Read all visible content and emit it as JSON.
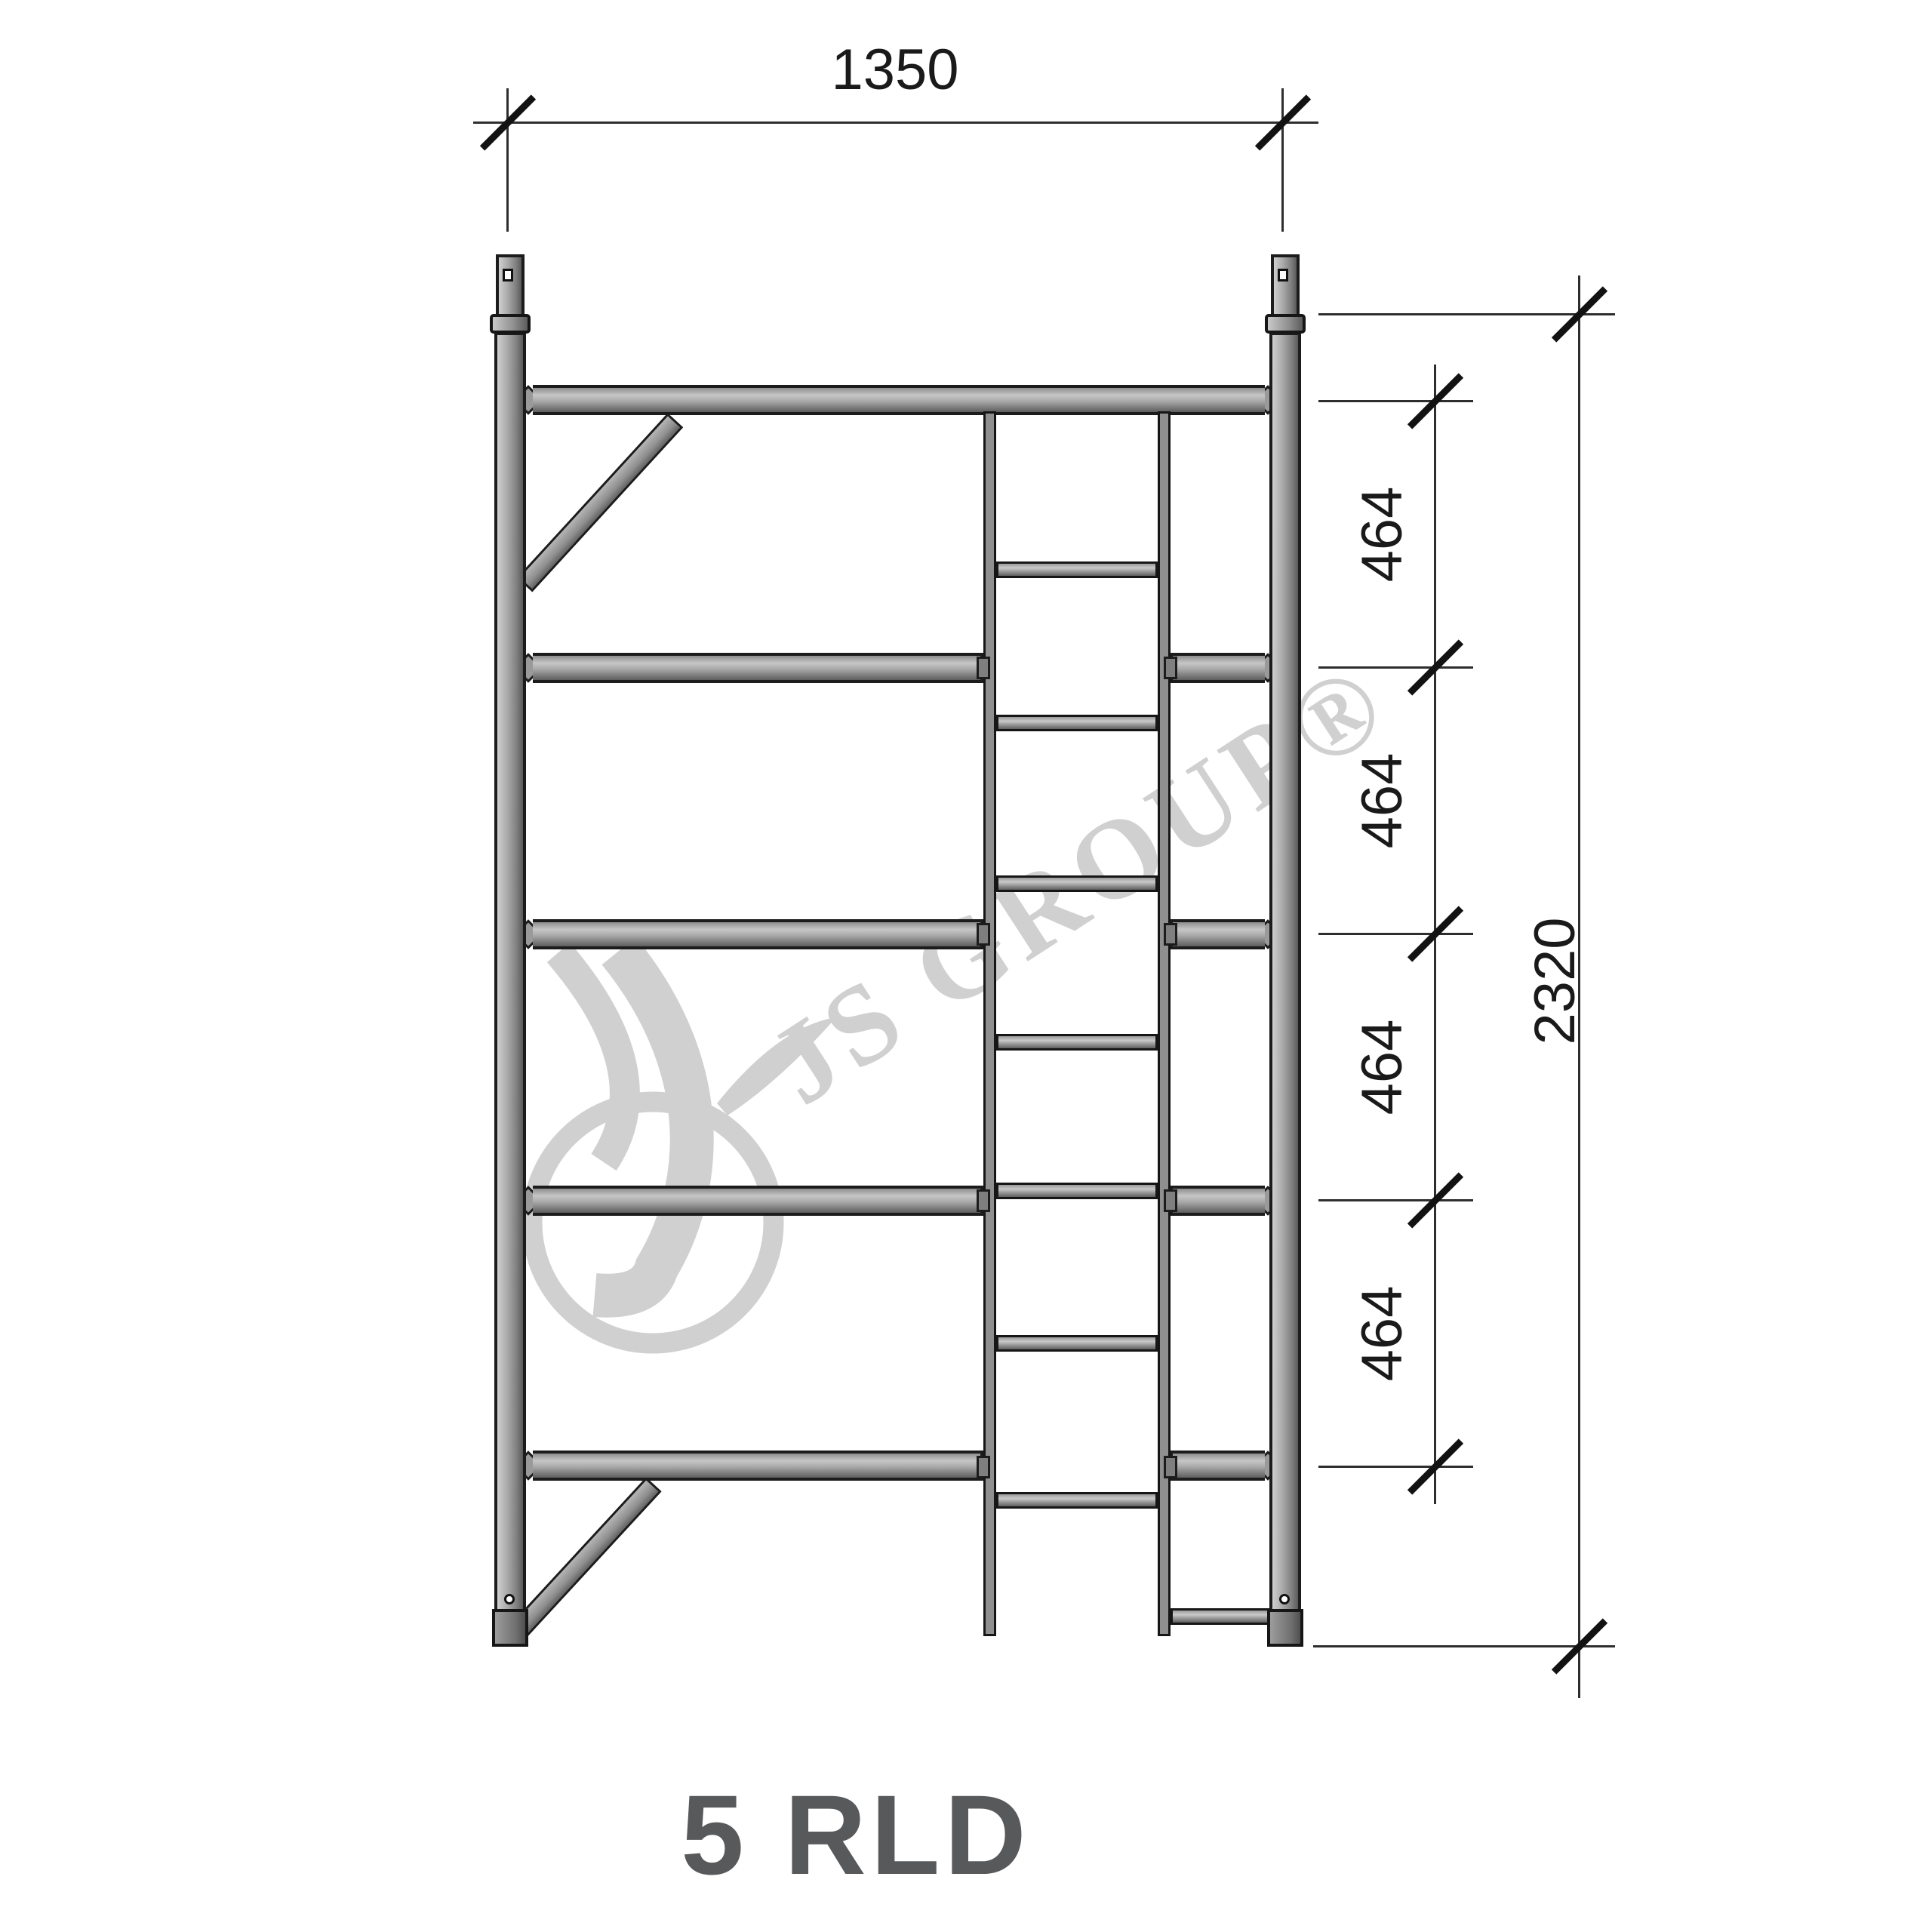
{
  "drawing": {
    "product_label": "5 RLD",
    "watermark_text": "JS GROUP®",
    "dims": {
      "top_width": "1350",
      "overall_height": "2320",
      "segments": [
        "464",
        "464",
        "464",
        "464"
      ]
    },
    "colors": {
      "tube_outline": "#1c1c1c",
      "tube_light": "#c6c6c6",
      "tube_dark": "#5e5e5e",
      "dimension_line": "#2e2e2e",
      "dimension_text": "#1a1a1a",
      "title_text": "#58595b",
      "watermark": "#d0d0d0"
    }
  }
}
